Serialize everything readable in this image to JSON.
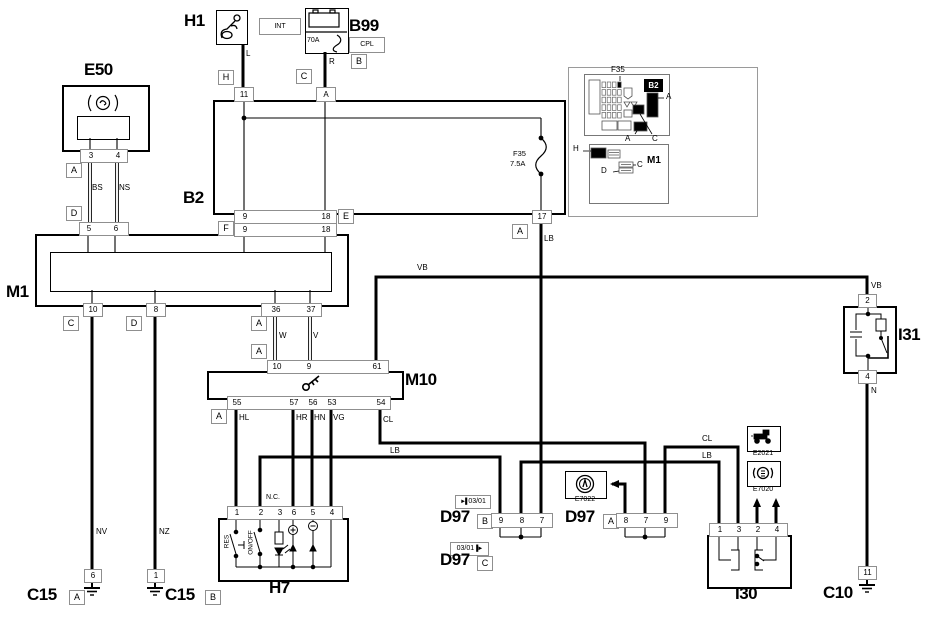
{
  "colors": {
    "line": "#000000",
    "box_border": "#8f8f8f",
    "background": "#ffffff"
  },
  "component_labels": [
    {
      "text": "H1",
      "x": 184,
      "y": 11,
      "name": "label-h1"
    },
    {
      "text": "B99",
      "x": 349,
      "y": 16,
      "name": "label-b99"
    },
    {
      "text": "E50",
      "x": 84,
      "y": 60,
      "name": "label-e50"
    },
    {
      "text": "B2",
      "x": 183,
      "y": 188,
      "name": "label-b2"
    },
    {
      "text": "M1",
      "x": 6,
      "y": 282,
      "name": "label-m1"
    },
    {
      "text": "M10",
      "x": 405,
      "y": 370,
      "name": "label-m10"
    },
    {
      "text": "H7",
      "x": 269,
      "y": 578,
      "name": "label-h7"
    },
    {
      "text": "D97",
      "x": 440,
      "y": 507,
      "name": "label-d97-b"
    },
    {
      "text": "D97",
      "x": 440,
      "y": 550,
      "name": "label-d97-c"
    },
    {
      "text": "D97",
      "x": 565,
      "y": 507,
      "name": "label-d97-a"
    },
    {
      "text": "I30",
      "x": 735,
      "y": 584,
      "name": "label-i30"
    },
    {
      "text": "I31",
      "x": 898,
      "y": 325,
      "name": "label-i31"
    },
    {
      "text": "C15",
      "x": 27,
      "y": 585,
      "name": "label-c15-a"
    },
    {
      "text": "C15",
      "x": 165,
      "y": 585,
      "name": "label-c15-b"
    },
    {
      "text": "C10",
      "x": 823,
      "y": 583,
      "name": "label-c10"
    }
  ],
  "wire_labels": [
    {
      "text": "L",
      "x": 246,
      "y": 49
    },
    {
      "text": "R",
      "x": 329,
      "y": 57
    },
    {
      "text": "BS",
      "x": 92,
      "y": 183
    },
    {
      "text": "NS",
      "x": 119,
      "y": 183
    },
    {
      "text": "W",
      "x": 279,
      "y": 331
    },
    {
      "text": "V",
      "x": 313,
      "y": 331
    },
    {
      "text": "VB",
      "x": 417,
      "y": 263
    },
    {
      "text": "VB",
      "x": 871,
      "y": 281
    },
    {
      "text": "LB",
      "x": 544,
      "y": 234
    },
    {
      "text": "N",
      "x": 871,
      "y": 386
    },
    {
      "text": "HL",
      "x": 239,
      "y": 413
    },
    {
      "text": "HR",
      "x": 296,
      "y": 413
    },
    {
      "text": "HN",
      "x": 314,
      "y": 413
    },
    {
      "text": "VG",
      "x": 333,
      "y": 413
    },
    {
      "text": "CL",
      "x": 383,
      "y": 415
    },
    {
      "text": "LB",
      "x": 390,
      "y": 446
    },
    {
      "text": "CL",
      "x": 702,
      "y": 434
    },
    {
      "text": "LB",
      "x": 702,
      "y": 451
    },
    {
      "text": "NV",
      "x": 96,
      "y": 527
    },
    {
      "text": "NZ",
      "x": 159,
      "y": 527
    }
  ],
  "small_labels": [
    {
      "text": "N.C.",
      "x": 266,
      "y": 494,
      "fs": 7,
      "name": "h7-nc-label"
    },
    {
      "text": "F35",
      "x": 513,
      "y": 149,
      "fs": 7.5,
      "name": "b2-fuse-name"
    },
    {
      "text": "7.5A",
      "x": 510,
      "y": 159,
      "fs": 7.5,
      "name": "b2-fuse-rating"
    },
    {
      "text": "70A",
      "x": 307,
      "y": 37,
      "fs": 7,
      "name": "b99-fuse-rating"
    },
    {
      "text": "RES",
      "x": 214,
      "y": 538,
      "w": 26,
      "fs": 6.5,
      "rot": 1,
      "center": 1,
      "name": "h7-res-label"
    },
    {
      "text": "ON/OFF",
      "x": 235,
      "y": 539,
      "w": 32,
      "fs": 6.5,
      "rot": 1,
      "center": 1,
      "name": "h7-onoff-label"
    },
    {
      "text": "E7022",
      "x": 565,
      "y": 496,
      "w": 40,
      "center": 1,
      "fs": 7,
      "name": "label-e7022"
    },
    {
      "text": "E2021",
      "x": 746,
      "y": 450,
      "w": 34,
      "center": 1,
      "fs": 7,
      "name": "label-e2021"
    },
    {
      "text": "E7020",
      "x": 746,
      "y": 486,
      "w": 34,
      "center": 1,
      "fs": 7,
      "name": "label-e7020"
    },
    {
      "text": "F35",
      "x": 611,
      "y": 65,
      "fs": 8,
      "name": "inset-f35-label"
    },
    {
      "text": "A",
      "x": 666,
      "y": 92,
      "fs": 8,
      "name": "inset-a1-label"
    },
    {
      "text": "A",
      "x": 625,
      "y": 134,
      "fs": 8,
      "name": "inset-a2-label"
    },
    {
      "text": "C",
      "x": 652,
      "y": 134,
      "fs": 8,
      "name": "inset-c1-label"
    },
    {
      "text": "H",
      "x": 573,
      "y": 144,
      "fs": 8,
      "name": "inset-h-label"
    },
    {
      "text": "M1",
      "x": 647,
      "y": 155,
      "fs": 10,
      "bold": 1,
      "name": "inset-m1-label"
    },
    {
      "text": "C",
      "x": 637,
      "y": 160,
      "fs": 8,
      "name": "inset-c2-label"
    },
    {
      "text": "D",
      "x": 601,
      "y": 166,
      "fs": 8,
      "name": "inset-d-label"
    }
  ],
  "connector_boxes": [
    {
      "text": "H",
      "x": 218,
      "y": 70,
      "name": "connector-h-h1"
    },
    {
      "text": "C",
      "x": 296,
      "y": 69,
      "name": "connector-c-b99"
    },
    {
      "text": "B",
      "x": 351,
      "y": 54,
      "name": "connector-b-b99"
    },
    {
      "text": "A",
      "x": 66,
      "y": 163,
      "name": "connector-a-e50"
    },
    {
      "text": "D",
      "x": 66,
      "y": 206,
      "name": "connector-d-e50"
    },
    {
      "text": "E",
      "x": 338,
      "y": 209,
      "name": "connector-e-b2"
    },
    {
      "text": "F",
      "x": 218,
      "y": 221,
      "name": "connector-f-m1"
    },
    {
      "text": "A",
      "x": 512,
      "y": 224,
      "name": "connector-a-b2-17"
    },
    {
      "text": "C",
      "x": 63,
      "y": 316,
      "name": "connector-c-m1"
    },
    {
      "text": "D",
      "x": 126,
      "y": 316,
      "name": "connector-d-m1"
    },
    {
      "text": "A",
      "x": 251,
      "y": 316,
      "name": "connector-a-m1"
    },
    {
      "text": "A",
      "x": 251,
      "y": 344,
      "name": "connector-a-m10-top"
    },
    {
      "text": "A",
      "x": 211,
      "y": 409,
      "name": "connector-a-m10-bottom"
    },
    {
      "text": "B",
      "x": 477,
      "y": 514,
      "name": "connector-b-d97"
    },
    {
      "text": "C",
      "x": 477,
      "y": 556,
      "name": "connector-c-d97"
    },
    {
      "text": "A",
      "x": 603,
      "y": 514,
      "name": "connector-a-d97"
    },
    {
      "text": "A",
      "x": 69,
      "y": 590,
      "name": "connector-a-c15"
    },
    {
      "text": "B",
      "x": 205,
      "y": 590,
      "name": "connector-b-c15"
    }
  ],
  "single_pins": [
    {
      "text": "11",
      "x": 234,
      "y": 87,
      "w": 18,
      "h": 13,
      "name": "pin-11-b2-top"
    },
    {
      "text": "A",
      "x": 316,
      "y": 87,
      "w": 18,
      "h": 13,
      "name": "pin-a-b2-top"
    },
    {
      "text": "17",
      "x": 532,
      "y": 210,
      "w": 18,
      "h": 12,
      "name": "pin-17-b2"
    },
    {
      "text": "10",
      "x": 83,
      "y": 303,
      "w": 18,
      "h": 12,
      "name": "pin-10-m1"
    },
    {
      "text": "8",
      "x": 146,
      "y": 303,
      "w": 18,
      "h": 12,
      "name": "pin-8-m1"
    },
    {
      "text": "2",
      "x": 858,
      "y": 294,
      "w": 17,
      "h": 12,
      "name": "pin-2-i31"
    },
    {
      "text": "4",
      "x": 858,
      "y": 370,
      "w": 17,
      "h": 12,
      "name": "pin-4-i31"
    },
    {
      "text": "6",
      "x": 84,
      "y": 569,
      "w": 16,
      "h": 12,
      "name": "pin-6-c15a"
    },
    {
      "text": "1",
      "x": 147,
      "y": 569,
      "w": 16,
      "h": 12,
      "name": "pin-1-c15b"
    },
    {
      "text": "11",
      "x": 858,
      "y": 566,
      "w": 17,
      "h": 12,
      "name": "pin-11-c10"
    }
  ],
  "pin_rows": [
    {
      "x": 80,
      "y": 149,
      "w": 46,
      "h": 12,
      "name": "pin-row-e50",
      "pins": [
        {
          "text": "3",
          "cx": 90
        },
        {
          "text": "4",
          "cx": 117
        }
      ]
    },
    {
      "x": 79,
      "y": 222,
      "w": 48,
      "h": 12,
      "name": "pin-row-m1-d",
      "pins": [
        {
          "text": "5",
          "cx": 88
        },
        {
          "text": "6",
          "cx": 115
        }
      ]
    },
    {
      "x": 234,
      "y": 210,
      "w": 101,
      "h": 12,
      "name": "pin-row-b2-e",
      "pins": [
        {
          "text": "9",
          "cx": 244
        },
        {
          "text": "18",
          "cx": 325
        }
      ]
    },
    {
      "x": 234,
      "y": 223,
      "w": 101,
      "h": 12,
      "name": "pin-row-m1-f",
      "pins": [
        {
          "text": "9",
          "cx": 244
        },
        {
          "text": "18",
          "cx": 325
        }
      ]
    },
    {
      "x": 261,
      "y": 303,
      "w": 59,
      "h": 12,
      "name": "pin-row-m1-a",
      "pins": [
        {
          "text": "36",
          "cx": 275
        },
        {
          "text": "37",
          "cx": 310
        }
      ]
    },
    {
      "x": 267,
      "y": 360,
      "w": 120,
      "h": 12,
      "name": "pin-row-m10-top",
      "pins": [
        {
          "text": "10",
          "cx": 276
        },
        {
          "text": "9",
          "cx": 308
        },
        {
          "text": "61",
          "cx": 376
        }
      ]
    },
    {
      "x": 227,
      "y": 396,
      "w": 162,
      "h": 12,
      "name": "pin-row-m10-bottom",
      "pins": [
        {
          "text": "55",
          "cx": 236
        },
        {
          "text": "57",
          "cx": 293
        },
        {
          "text": "56",
          "cx": 312
        },
        {
          "text": "53",
          "cx": 331
        },
        {
          "text": "54",
          "cx": 380
        }
      ]
    },
    {
      "x": 227,
      "y": 506,
      "w": 114,
      "h": 12,
      "name": "pin-row-h7",
      "pins": [
        {
          "text": "1",
          "cx": 236
        },
        {
          "text": "2",
          "cx": 260
        },
        {
          "text": "3",
          "cx": 279
        },
        {
          "text": "6",
          "cx": 293
        },
        {
          "text": "5",
          "cx": 312
        },
        {
          "text": "4",
          "cx": 331
        }
      ]
    },
    {
      "x": 491,
      "y": 513,
      "w": 60,
      "h": 13,
      "name": "pin-row-d97-b",
      "pins": [
        {
          "text": "9",
          "cx": 500
        },
        {
          "text": "8",
          "cx": 521
        },
        {
          "text": "7",
          "cx": 541
        }
      ]
    },
    {
      "x": 616,
      "y": 513,
      "w": 60,
      "h": 13,
      "name": "pin-row-d97-a",
      "pins": [
        {
          "text": "8",
          "cx": 625
        },
        {
          "text": "7",
          "cx": 645
        },
        {
          "text": "9",
          "cx": 665
        }
      ]
    },
    {
      "x": 709,
      "y": 523,
      "w": 77,
      "h": 12,
      "name": "pin-row-i30",
      "pins": [
        {
          "text": "1",
          "cx": 719
        },
        {
          "text": "3",
          "cx": 738
        },
        {
          "text": "2",
          "cx": 757
        },
        {
          "text": "4",
          "cx": 776
        }
      ]
    }
  ],
  "badges": {
    "int": "INT",
    "cpl": "CPL",
    "d97b_icon": "►▌",
    "d97b_text": "03/01",
    "d97c_text": "03/01",
    "d97c_icon": "▐►",
    "inset_b2": "B2"
  },
  "svg": {
    "thick": [
      "M243,44 V87",
      "M325,52 V87",
      "M541,222 V513",
      "M376,360 V277 H867 V294",
      "M867,382 V566",
      "M92,315 V569",
      "M155,315 V569",
      "M236,408 V506",
      "M293,408 V506",
      "M312,408 V506",
      "M331,408 V506",
      "M380,408 V443 H645 V513",
      "M665,513 V447 H738 V523",
      "M260,506 V457 H500 V513",
      "M521,513 V462 H719 V523",
      "M625,513 V484 H612",
      "M757,523 V502",
      "M776,523 V502"
    ],
    "thin": [
      "M244,100 V210",
      "M325,100 V210",
      "M244,118 H541",
      "M541,118 V138",
      "M541,174 V210",
      "M88,234 V252",
      "M115,234 V252",
      "M244,234 V252",
      "M325,234 V252",
      "M92,290 V303",
      "M155,290 V303",
      "M275,290 V303",
      "M310,290 V303",
      "M90,138 V149",
      "M117,138 V149",
      "M500,526 V537",
      "M521,526 V537",
      "M541,526 V537",
      "M500,537 H541",
      "M625,526 V537",
      "M645,526 V537",
      "M665,526 V537",
      "M625,537 H665"
    ],
    "double": [
      {
        "x": 90,
        "y1": 161,
        "y2": 222
      },
      {
        "x": 117,
        "y1": 161,
        "y2": 222
      },
      {
        "x": 275,
        "y1": 315,
        "y2": 360
      },
      {
        "x": 310,
        "y1": 315,
        "y2": 360
      }
    ],
    "dots": [
      [
        244,
        118
      ],
      [
        541,
        138
      ],
      [
        541,
        174
      ],
      [
        521,
        537
      ],
      [
        645,
        537
      ]
    ],
    "arrows": [
      {
        "x": 612,
        "y": 484,
        "dir": "left",
        "name": "arrow-to-e7022"
      },
      {
        "x": 757,
        "y": 500,
        "dir": "up",
        "name": "arrow-to-e2021"
      },
      {
        "x": 776,
        "y": 500,
        "dir": "up",
        "name": "arrow-to-e7020"
      }
    ],
    "grounds": [
      [
        92,
        581
      ],
      [
        155,
        581
      ],
      [
        867,
        578
      ]
    ],
    "inset_leaders": [
      "M620,76 V81",
      "M658,98 H664",
      "M640,114 L652,134",
      "M637,131 L635,134",
      "M583,151 H591",
      "M633,165 H636",
      "M619,171 L613,172"
    ]
  }
}
